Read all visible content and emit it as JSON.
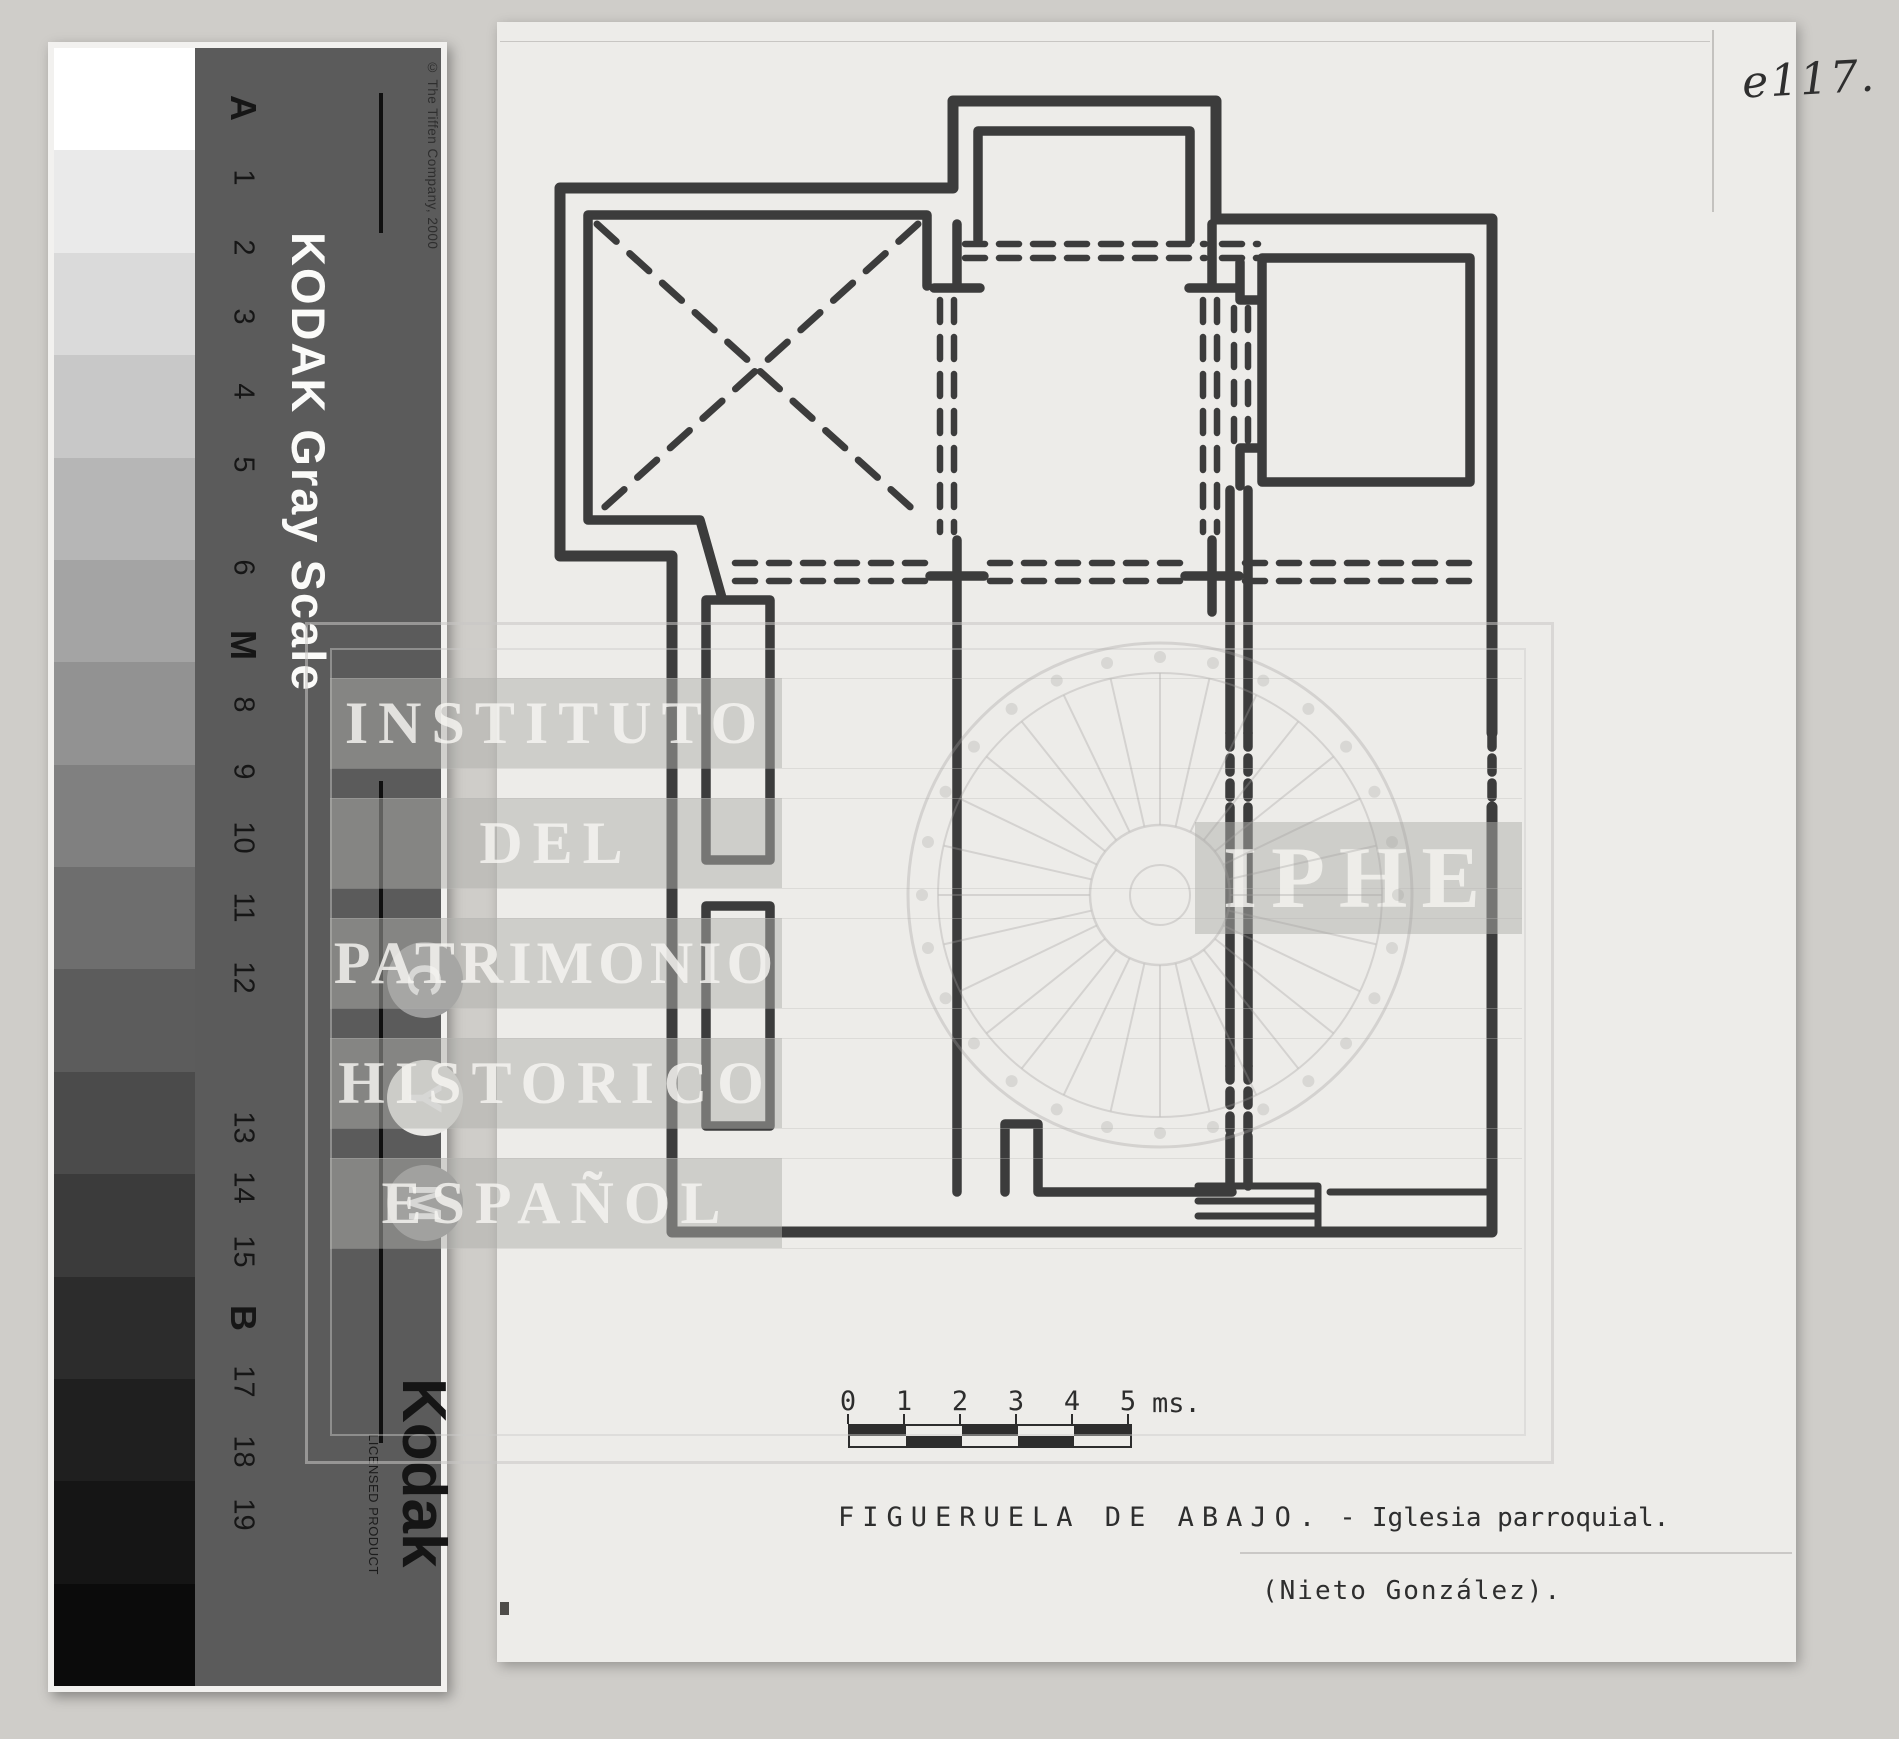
{
  "page": {
    "background": "#cfcdc9",
    "paper": "#edece9"
  },
  "gray_card": {
    "panel_color": "#5b5b5b",
    "patches": [
      "#ffffff",
      "#eaeaea",
      "#dadada",
      "#c8c8c8",
      "#b6b6b6",
      "#a4a4a4",
      "#929292",
      "#808080",
      "#6e6e6e",
      "#5c5c5c",
      "#4b4b4b",
      "#3b3b3b",
      "#2c2c2c",
      "#1f1f1f",
      "#151515",
      "#0b0b0b"
    ],
    "labels": [
      "A",
      "1",
      "2",
      "3",
      "4",
      "5",
      "6",
      "M",
      "8",
      "9",
      "10",
      "11",
      "12",
      "13",
      "14",
      "15",
      "B",
      "17",
      "18",
      "19"
    ],
    "title": "KODAK Gray Scale",
    "copyright": "© The Tiffen Company, 2000",
    "circles": [
      {
        "letter": "C",
        "fill": "#9c9c9c"
      },
      {
        "letter": "Y",
        "fill": "#e9e8e5"
      },
      {
        "letter": "M",
        "fill": "#939393"
      }
    ],
    "logo": "Kodak",
    "licensed": "LICENSED PRODUCT"
  },
  "document": {
    "handwritten_ref": "e117.",
    "scale_bar": {
      "ticks": [
        "0",
        "1",
        "2",
        "3",
        "4",
        "5"
      ],
      "unit": "ms."
    },
    "caption": {
      "site": "FIGUERUELA DE ABAJO.",
      "separator": "-",
      "subject": "Iglesia parroquial.",
      "author": "(Nieto González)."
    }
  },
  "watermark": {
    "lines": [
      "INSTITUTO",
      "DEL",
      "PATRIMONIO",
      "HISTORICO",
      "ESPAÑOL"
    ],
    "acronym": "IPHE",
    "color": "#c6c5c2"
  }
}
